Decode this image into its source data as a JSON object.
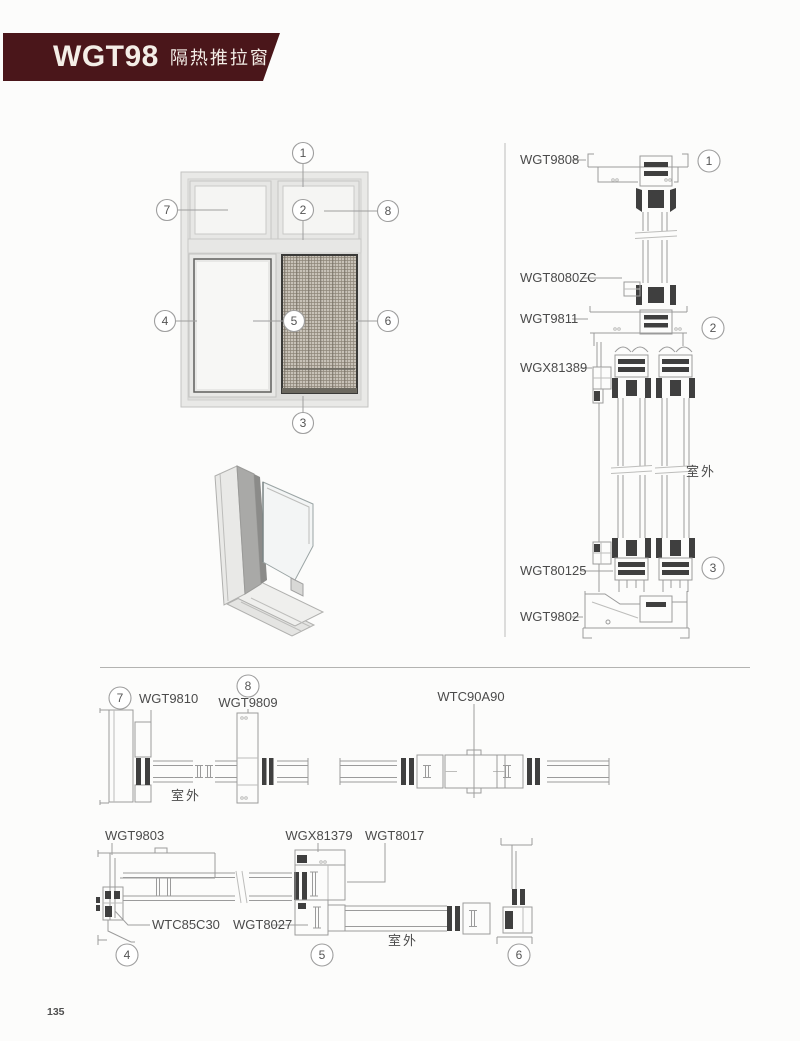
{
  "header": {
    "model": "WGT98",
    "product_name": "隔热推拉窗"
  },
  "colors": {
    "banner": "#4a161a",
    "label_text": "#4b4b4b",
    "drawing_line": "#9b9b9b",
    "dark_hardware": "#3f3f3f",
    "frame_fill": "#e9e9e7",
    "glass_fill": "#f6f6f4",
    "mesh_fill": "#c8c2b8",
    "mesh_line": "#8e8679",
    "callout_stroke": "#9e9e9e"
  },
  "elevation": {
    "callouts": [
      "1",
      "2",
      "3",
      "4",
      "5",
      "6",
      "7",
      "8"
    ]
  },
  "vertical_section": {
    "parts": [
      {
        "label": "WGT9808"
      },
      {
        "label": "WGT8080ZC"
      },
      {
        "label": "WGT9811"
      },
      {
        "label": "WGX81389"
      },
      {
        "label": "WGT80125"
      },
      {
        "label": "WGT9802"
      }
    ],
    "callout_1": "1",
    "callout_2": "2",
    "callout_3": "3",
    "outdoor_label": "室外"
  },
  "plan_top": {
    "callout_7": "7",
    "part_7": "WGT9810",
    "callout_8": "8",
    "part_8": "WGT9809",
    "connector": "WTC90A90",
    "outdoor_label": "室外"
  },
  "plan_bottom": {
    "part_frame": "WGT9803",
    "part_screen": "WGX81379",
    "part_sash": "WGT8017",
    "part_corner": "WTC85C30",
    "part_bottom_rail": "WGT8027",
    "callout_4": "4",
    "callout_5": "5",
    "callout_6": "6",
    "outdoor_label": "室外"
  },
  "footer": {
    "page_number": "135"
  }
}
